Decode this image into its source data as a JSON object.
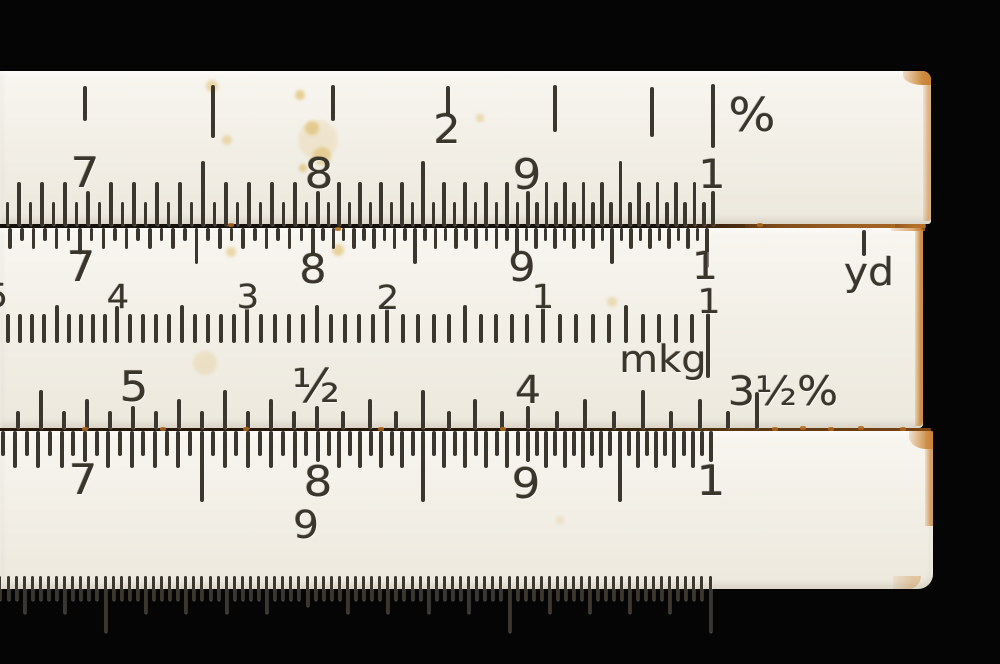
{
  "meta": {
    "background": "#050505",
    "subject": "slide-rule-close-up-photo"
  },
  "colors": {
    "strip": "#f3f0e8",
    "ink": "#3b372f",
    "rust": "#c87f2e",
    "joint_dark": "#1a130c",
    "joint_brown": "#3a2813",
    "stain": "#d8a93f"
  },
  "strips": [
    {
      "name": "top-stator",
      "x": 0,
      "y": 71,
      "w": 931,
      "h": 153,
      "radius": "0 9px 3px 0"
    },
    {
      "name": "slide",
      "x": 0,
      "y": 228,
      "w": 923,
      "h": 200,
      "radius": "0 4px 4px 0"
    },
    {
      "name": "bottom-stator",
      "x": 0,
      "y": 431,
      "w": 933,
      "h": 158,
      "radius": "0 3px 15px 0"
    }
  ],
  "joints": [
    {
      "name": "joint-upper",
      "y": 224,
      "h": 4,
      "w": 926,
      "css": "linear-gradient(90deg,#15100a 0%,#15100a 72%,#6b3d14 84%,#8a4f1a 100%)"
    },
    {
      "name": "joint-lower",
      "y": 428,
      "h": 3,
      "w": 931,
      "css": "linear-gradient(90deg,#241709 0%,#241709 62%,#55350f 78%,#7a4414 100%)"
    }
  ],
  "scales": [
    {
      "id": "percent-scale-top",
      "type": "explicit",
      "tick_w": 4.5,
      "ticks": [
        [
          85,
          86,
          121
        ],
        [
          213,
          85,
          138
        ],
        [
          333,
          85,
          121
        ],
        [
          448,
          86,
          116
        ],
        [
          555,
          85,
          132
        ],
        [
          652,
          87,
          137
        ],
        [
          713,
          84,
          148
        ]
      ]
    },
    {
      "id": "top-stator-log-scale",
      "type": "comb20",
      "dir": "up",
      "base": 226,
      "tick_w": 3.6,
      "anchors": [
        88,
        318,
        528,
        713
      ],
      "len": {
        "anchor": 35,
        "even": 44,
        "odd": 24,
        "half": 65
      },
      "extend_left": 8
    },
    {
      "id": "slide-top-log-scale",
      "type": "comb20",
      "dir": "down",
      "base": 228,
      "tick_w": 3.6,
      "anchors": [
        80,
        313,
        517,
        707
      ],
      "len": {
        "anchor": 27,
        "even": 21,
        "odd": 13,
        "half": 36,
        "last_anchor": 40
      },
      "extend_left": 7
    },
    {
      "id": "slide-middle-scale",
      "type": "comb10",
      "dir": "up",
      "base": 343,
      "tick_w": 4,
      "anchors": [
        -4,
        117,
        247,
        387,
        543,
        709
      ],
      "len": {
        "anchor": 37,
        "mid": 38,
        "minor": 29,
        "last_anchor": 0
      }
    },
    {
      "id": "slide-bottom-percent-scale",
      "type": "comb8",
      "dir": "up",
      "base": 429,
      "tick_w": 4,
      "anchors": [
        133,
        317,
        528,
        757
      ],
      "len": {
        "anchor": 23,
        "tall": 39,
        "med": 30,
        "minor": 18,
        "last_anchor": 37
      },
      "extend_left": 5
    },
    {
      "id": "bottom-stator-log-scale",
      "type": "comb20",
      "dir": "down",
      "base": 431,
      "tick_w": 4,
      "anchors": [
        85,
        318,
        528,
        711
      ],
      "len": {
        "anchor": 31,
        "even": 37,
        "odd": 25,
        "half": 71
      },
      "extend_left": 8
    },
    {
      "id": "bottom-fine-ruler-scale",
      "type": "ruler",
      "dir": "down",
      "base": 576,
      "tick_w": 3,
      "majors": [
        105,
        307,
        509,
        710
      ],
      "label_major_index": 1,
      "len": {
        "major": 57,
        "med": 38,
        "minor": 25,
        "major_with_label": 31
      },
      "extend_left": 13
    }
  ],
  "extra_ticks": [
    {
      "name": "yd-index-tick",
      "x": 864,
      "y1": 230,
      "y2": 256,
      "w": 3.5
    },
    {
      "name": "slide-index-tick",
      "x": 708,
      "y1": 313,
      "y2": 378,
      "w": 4
    }
  ],
  "labels": [
    {
      "n": "percent-scale-number-2",
      "t": "2",
      "x": 447,
      "y": 110,
      "fs": 40
    },
    {
      "n": "percent-unit-label",
      "t": "%",
      "x": 752,
      "y": 92,
      "fs": 46
    },
    {
      "n": "top-stator-number-7",
      "t": "7",
      "x": 85,
      "y": 152,
      "fs": 42
    },
    {
      "n": "top-stator-number-8",
      "t": "8",
      "x": 319,
      "y": 153,
      "fs": 42
    },
    {
      "n": "top-stator-number-9",
      "t": "9",
      "x": 527,
      "y": 154,
      "fs": 42
    },
    {
      "n": "top-stator-number-1",
      "t": "1",
      "x": 712,
      "y": 155,
      "fs": 40
    },
    {
      "n": "slide-top-number-7",
      "t": "7",
      "x": 81,
      "y": 246,
      "fs": 42
    },
    {
      "n": "slide-top-number-8",
      "t": "8",
      "x": 313,
      "y": 250,
      "fs": 40
    },
    {
      "n": "slide-top-number-9",
      "t": "9",
      "x": 522,
      "y": 248,
      "fs": 40
    },
    {
      "n": "slide-top-number-1",
      "t": "1",
      "x": 705,
      "y": 247,
      "fs": 38
    },
    {
      "n": "yd-unit-label",
      "t": "yd",
      "x": 869,
      "y": 253,
      "fs": 38
    },
    {
      "n": "slide-middle-number-5",
      "t": "5",
      "x": -3,
      "y": 279,
      "fs": 33
    },
    {
      "n": "slide-middle-number-4",
      "t": "4",
      "x": 118,
      "y": 280,
      "fs": 33
    },
    {
      "n": "slide-middle-number-3",
      "t": "3",
      "x": 248,
      "y": 280,
      "fs": 33
    },
    {
      "n": "slide-middle-number-2",
      "t": "2",
      "x": 388,
      "y": 281,
      "fs": 33
    },
    {
      "n": "slide-middle-number-1",
      "t": "1",
      "x": 543,
      "y": 280,
      "fs": 33
    },
    {
      "n": "slide-middle-index-number-1",
      "t": "1",
      "x": 709,
      "y": 285,
      "fs": 34
    },
    {
      "n": "mkg-unit-label",
      "t": "mkg",
      "x": 663,
      "y": 341,
      "fs": 37
    },
    {
      "n": "slide-bottom-number-5",
      "t": "5",
      "x": 134,
      "y": 366,
      "fs": 42
    },
    {
      "n": "slide-bottom-number-half",
      "t": "½",
      "x": 316,
      "y": 363,
      "fs": 46
    },
    {
      "n": "slide-bottom-number-4",
      "t": "4",
      "x": 528,
      "y": 371,
      "fs": 38
    },
    {
      "n": "slide-bottom-number-3half",
      "t": "3½%",
      "x": 783,
      "y": 372,
      "fs": 40
    },
    {
      "n": "bottom-stator-number-7",
      "t": "7",
      "x": 83,
      "y": 459,
      "fs": 42
    },
    {
      "n": "bottom-stator-number-8",
      "t": "8",
      "x": 318,
      "y": 461,
      "fs": 42
    },
    {
      "n": "bottom-stator-number-9",
      "t": "9",
      "x": 526,
      "y": 463,
      "fs": 42
    },
    {
      "n": "bottom-stator-number-1",
      "t": "1",
      "x": 711,
      "y": 460,
      "fs": 42
    },
    {
      "n": "fine-ruler-number-9",
      "t": "9",
      "x": 306,
      "y": 506,
      "fs": 38
    }
  ],
  "stains": [
    {
      "x": 318,
      "y": 140,
      "r": 20,
      "o": 0.15
    },
    {
      "x": 300,
      "y": 95,
      "r": 5,
      "o": 0.5
    },
    {
      "x": 312,
      "y": 128,
      "r": 7,
      "o": 0.45
    },
    {
      "x": 322,
      "y": 156,
      "r": 9,
      "o": 0.4
    },
    {
      "x": 303,
      "y": 168,
      "r": 4,
      "o": 0.5
    },
    {
      "x": 227,
      "y": 140,
      "r": 5,
      "o": 0.35
    },
    {
      "x": 212,
      "y": 86,
      "r": 6,
      "o": 0.4
    },
    {
      "x": 338,
      "y": 250,
      "r": 6,
      "o": 0.45
    },
    {
      "x": 231,
      "y": 252,
      "r": 5,
      "o": 0.4
    },
    {
      "x": 205,
      "y": 363,
      "r": 12,
      "o": 0.18
    },
    {
      "x": 612,
      "y": 302,
      "r": 5,
      "o": 0.3
    },
    {
      "x": 480,
      "y": 118,
      "r": 4,
      "o": 0.35
    },
    {
      "x": 560,
      "y": 520,
      "r": 4,
      "o": 0.2
    }
  ],
  "rust_patches": [
    {
      "x": 903,
      "y": 71,
      "w": 28,
      "h": 14,
      "o": 0.9,
      "rad": "0 9px 0 70%"
    },
    {
      "x": 923,
      "y": 71,
      "w": 8,
      "h": 150,
      "o": 0.55,
      "rad": "0 9px 3px 0"
    },
    {
      "x": 915,
      "y": 228,
      "w": 8,
      "h": 198,
      "o": 0.85,
      "rad": "0 4px 4px 0"
    },
    {
      "x": 891,
      "y": 224,
      "w": 34,
      "h": 7,
      "o": 0.7,
      "rad": "0"
    },
    {
      "x": 745,
      "y": 224,
      "w": 150,
      "h": 4,
      "o": 0.45,
      "rad": "0"
    },
    {
      "x": 925,
      "y": 431,
      "w": 8,
      "h": 95,
      "o": 0.7,
      "rad": "0 3px 0 0"
    },
    {
      "x": 909,
      "y": 431,
      "w": 24,
      "h": 18,
      "o": 0.8,
      "rad": "0 0 0 70%"
    },
    {
      "x": 893,
      "y": 576,
      "w": 28,
      "h": 13,
      "o": 0.35,
      "rad": "0 0 15px 0"
    }
  ],
  "rust_dots": [
    {
      "x": 82,
      "y": 427
    },
    {
      "x": 160,
      "y": 427
    },
    {
      "x": 243,
      "y": 427
    },
    {
      "x": 378,
      "y": 427
    },
    {
      "x": 500,
      "y": 427
    },
    {
      "x": 772,
      "y": 427
    },
    {
      "x": 800,
      "y": 426
    },
    {
      "x": 828,
      "y": 427
    },
    {
      "x": 858,
      "y": 426
    },
    {
      "x": 900,
      "y": 427
    },
    {
      "x": 228,
      "y": 223
    },
    {
      "x": 757,
      "y": 223
    },
    {
      "x": 335,
      "y": 227
    }
  ]
}
